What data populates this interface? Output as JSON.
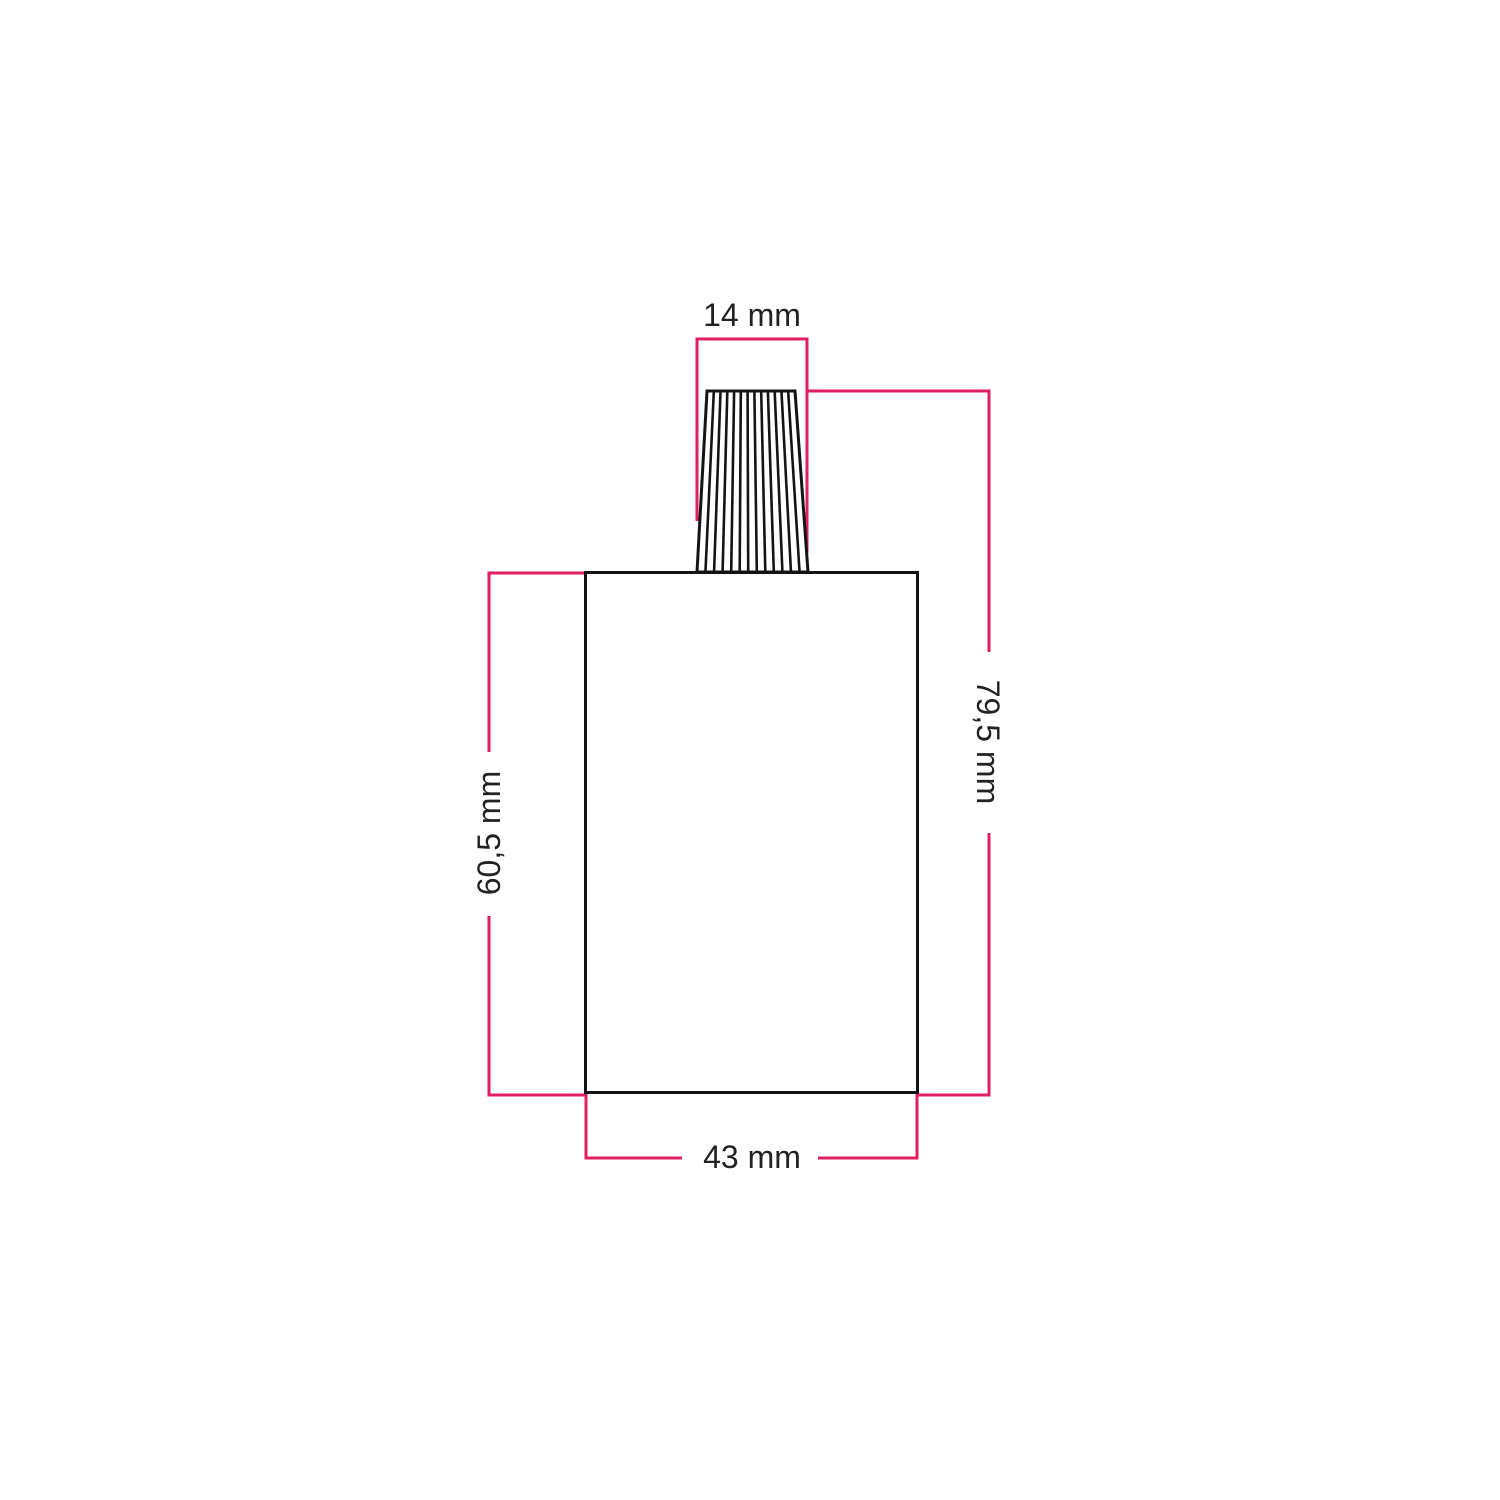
{
  "diagram": {
    "labels": {
      "top_width": "14 mm",
      "total_height": "79,5 mm",
      "body_height": "60,5 mm",
      "body_width": "43 mm"
    },
    "colors": {
      "dimension_line": "#e11e5f",
      "drawing_line": "#141414",
      "text_color": "#222222",
      "background": "#ffffff"
    }
  }
}
